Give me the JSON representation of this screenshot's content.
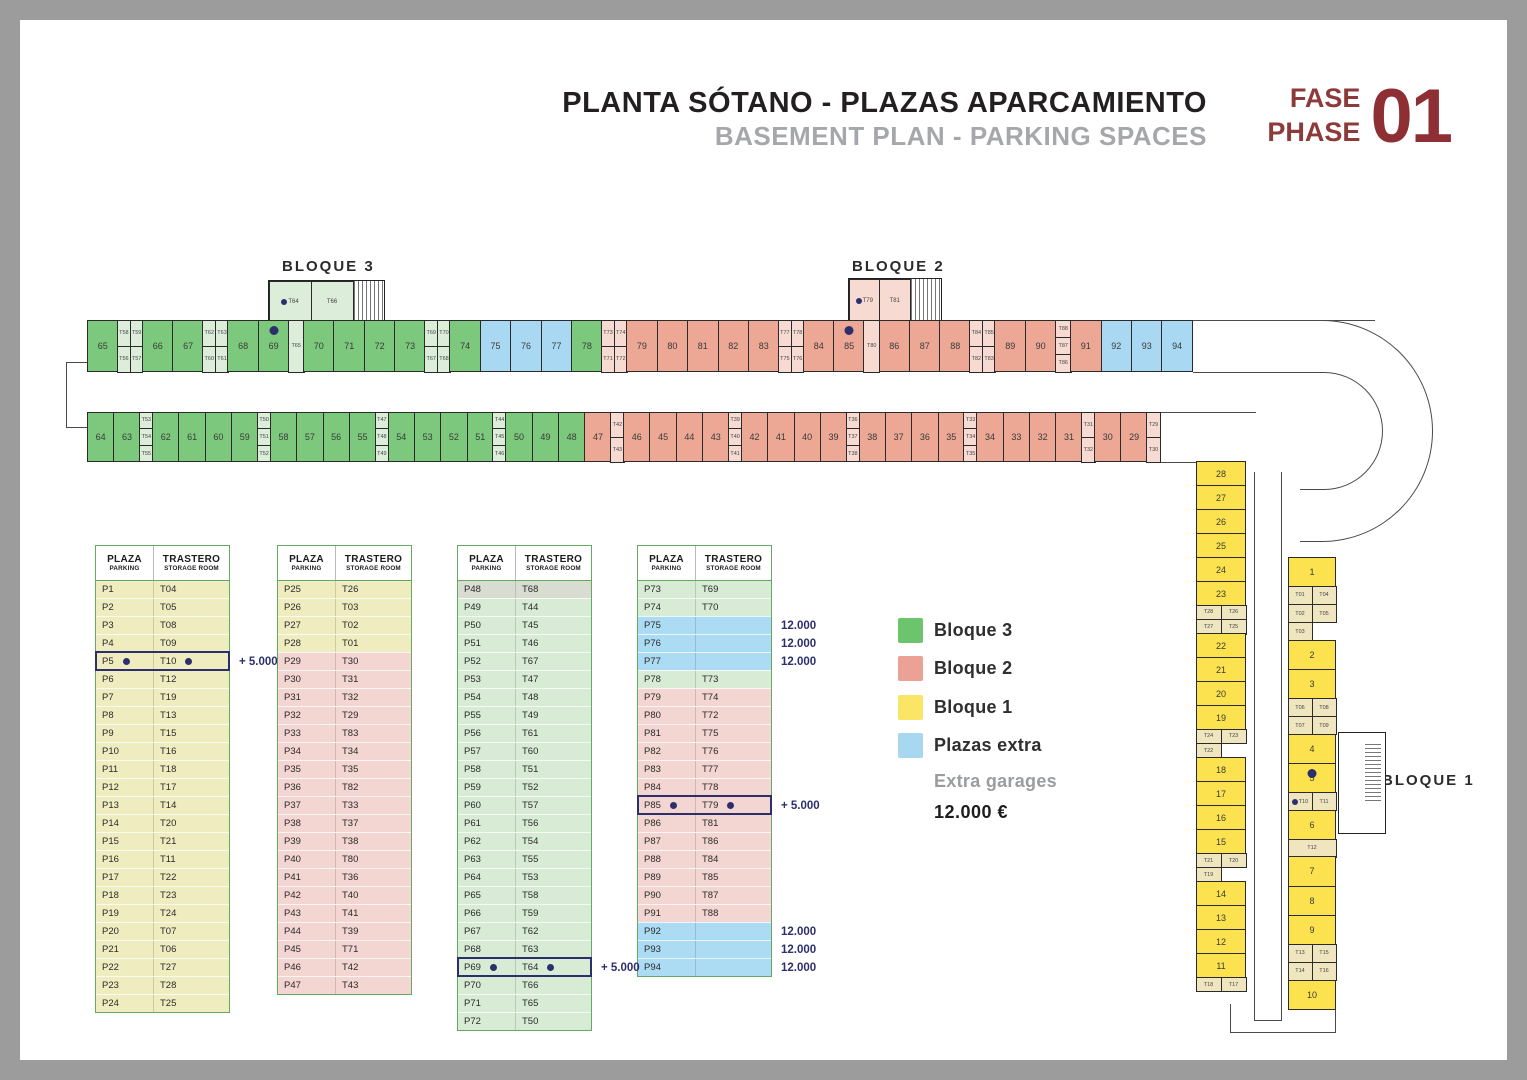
{
  "title": {
    "main": "PLANTA SÓTANO - PLAZAS APARCAMIENTO",
    "sub": "BASEMENT PLAN - PARKING SPACES",
    "fase": "FASE",
    "phase": "PHASE",
    "number": "01"
  },
  "plan": {
    "labels": {
      "bloque3": "BLOQUE 3",
      "bloque2": "BLOQUE 2",
      "bloque1": "BLOQUE 1"
    },
    "top_row": [
      {
        "s": "65",
        "c": "g"
      },
      {
        "st": [
          "T58",
          "T59",
          "T56",
          "T57"
        ],
        "c": "g",
        "w": 2
      },
      {
        "s": "66",
        "c": "g"
      },
      {
        "s": "67",
        "c": "g"
      },
      {
        "st": [
          "T62",
          "T63",
          "T60",
          "T61"
        ],
        "c": "g",
        "w": 2
      },
      {
        "s": "68",
        "c": "g"
      },
      {
        "s": "69",
        "c": "g",
        "dot": true
      },
      {
        "st": [
          "T65"
        ],
        "c": "g",
        "w": 1
      },
      {
        "s": "70",
        "c": "g"
      },
      {
        "s": "71",
        "c": "g"
      },
      {
        "s": "72",
        "c": "g"
      },
      {
        "s": "73",
        "c": "g"
      },
      {
        "st": [
          "T69",
          "T70",
          "T67",
          "T68"
        ],
        "c": "g",
        "w": 2
      },
      {
        "s": "74",
        "c": "g"
      },
      {
        "s": "75",
        "c": "b"
      },
      {
        "s": "76",
        "c": "b"
      },
      {
        "s": "77",
        "c": "b"
      },
      {
        "s": "78",
        "c": "g"
      },
      {
        "st": [
          "T73",
          "T74",
          "T71",
          "T72"
        ],
        "c": "s",
        "w": 2
      },
      {
        "s": "79",
        "c": "s"
      },
      {
        "s": "80",
        "c": "s"
      },
      {
        "s": "81",
        "c": "s"
      },
      {
        "s": "82",
        "c": "s"
      },
      {
        "s": "83",
        "c": "s"
      },
      {
        "st": [
          "T77",
          "T78",
          "T75",
          "T76"
        ],
        "c": "s",
        "w": 2
      },
      {
        "s": "84",
        "c": "s"
      },
      {
        "s": "85",
        "c": "s",
        "dot": true
      },
      {
        "st": [
          "T80"
        ],
        "c": "s",
        "w": 1
      },
      {
        "s": "86",
        "c": "s"
      },
      {
        "s": "87",
        "c": "s"
      },
      {
        "s": "88",
        "c": "s"
      },
      {
        "st": [
          "T84",
          "T85",
          "T82",
          "T83"
        ],
        "c": "s",
        "w": 2
      },
      {
        "s": "89",
        "c": "s"
      },
      {
        "s": "90",
        "c": "s"
      },
      {
        "st": [
          "T88",
          "T87",
          "T86"
        ],
        "c": "s",
        "w": 1
      },
      {
        "s": "91",
        "c": "s"
      },
      {
        "s": "92",
        "c": "b"
      },
      {
        "s": "93",
        "c": "b"
      },
      {
        "s": "94",
        "c": "b"
      }
    ],
    "bottom_row": [
      {
        "s": "64",
        "c": "g"
      },
      {
        "s": "63",
        "c": "g"
      },
      {
        "st": [
          "T53",
          "T54",
          "T55"
        ],
        "c": "g",
        "w": 1
      },
      {
        "s": "62",
        "c": "g"
      },
      {
        "s": "61",
        "c": "g"
      },
      {
        "s": "60",
        "c": "g"
      },
      {
        "s": "59",
        "c": "g"
      },
      {
        "st": [
          "T50",
          "T51",
          "T52"
        ],
        "c": "g",
        "w": 1
      },
      {
        "s": "58",
        "c": "g"
      },
      {
        "s": "57",
        "c": "g"
      },
      {
        "s": "56",
        "c": "g"
      },
      {
        "s": "55",
        "c": "g"
      },
      {
        "st": [
          "T47",
          "T48",
          "T49"
        ],
        "c": "g",
        "w": 1
      },
      {
        "s": "54",
        "c": "g"
      },
      {
        "s": "53",
        "c": "g"
      },
      {
        "s": "52",
        "c": "g"
      },
      {
        "s": "51",
        "c": "g"
      },
      {
        "st": [
          "T44",
          "T45",
          "T46"
        ],
        "c": "g",
        "w": 1
      },
      {
        "s": "50",
        "c": "g"
      },
      {
        "s": "49",
        "c": "g"
      },
      {
        "s": "48",
        "c": "g"
      },
      {
        "s": "47",
        "c": "s"
      },
      {
        "st": [
          "T42",
          "T43"
        ],
        "c": "s",
        "w": 1
      },
      {
        "s": "46",
        "c": "s"
      },
      {
        "s": "45",
        "c": "s"
      },
      {
        "s": "44",
        "c": "s"
      },
      {
        "s": "43",
        "c": "s"
      },
      {
        "st": [
          "T39",
          "T40",
          "T41"
        ],
        "c": "s",
        "w": 1
      },
      {
        "s": "42",
        "c": "s"
      },
      {
        "s": "41",
        "c": "s"
      },
      {
        "s": "40",
        "c": "s"
      },
      {
        "s": "39",
        "c": "s"
      },
      {
        "st": [
          "T36",
          "T37",
          "T38"
        ],
        "c": "s",
        "w": 1
      },
      {
        "s": "38",
        "c": "s"
      },
      {
        "s": "37",
        "c": "s"
      },
      {
        "s": "36",
        "c": "s"
      },
      {
        "s": "35",
        "c": "s"
      },
      {
        "st": [
          "T33",
          "T34",
          "T35"
        ],
        "c": "s",
        "w": 1
      },
      {
        "s": "34",
        "c": "s"
      },
      {
        "s": "33",
        "c": "s"
      },
      {
        "s": "32",
        "c": "s"
      },
      {
        "s": "31",
        "c": "s"
      },
      {
        "st": [
          "T31",
          "T32"
        ],
        "c": "s",
        "w": 1
      },
      {
        "s": "30",
        "c": "s"
      },
      {
        "s": "29",
        "c": "s"
      },
      {
        "st": [
          "T29",
          "T30"
        ],
        "c": "s",
        "w": 1
      }
    ],
    "col_a": [
      {
        "s": "28",
        "c": "y"
      },
      {
        "s": "27",
        "c": "y"
      },
      {
        "s": "26",
        "c": "y"
      },
      {
        "s": "25",
        "c": "y"
      },
      {
        "s": "24",
        "c": "y"
      },
      {
        "s": "23",
        "c": "y"
      },
      {
        "st": [
          "T28",
          "T26",
          "T27",
          "T25"
        ],
        "c": "y",
        "w": 2
      },
      {
        "s": "22",
        "c": "y"
      },
      {
        "s": "21",
        "c": "y"
      },
      {
        "s": "20",
        "c": "y"
      },
      {
        "s": "19",
        "c": "y"
      },
      {
        "st": [
          "T24",
          "T23",
          "T22"
        ],
        "c": "y",
        "w": 2
      },
      {
        "s": "18",
        "c": "y"
      },
      {
        "s": "17",
        "c": "y"
      },
      {
        "s": "16",
        "c": "y"
      },
      {
        "s": "15",
        "c": "y"
      },
      {
        "st": [
          "T21",
          "T20",
          "T19"
        ],
        "c": "y",
        "w": 2
      },
      {
        "s": "14",
        "c": "y"
      },
      {
        "s": "13",
        "c": "y"
      },
      {
        "s": "12",
        "c": "y"
      },
      {
        "s": "11",
        "c": "y"
      },
      {
        "st": [
          "T18",
          "T17"
        ],
        "c": "y",
        "w": 2
      }
    ],
    "col_b": [
      {
        "s": "1",
        "c": "y"
      },
      {
        "st": [
          "T01",
          "T04",
          "T02",
          "T05",
          "T03"
        ],
        "c": "y",
        "w": 2
      },
      {
        "s": "2",
        "c": "y"
      },
      {
        "s": "3",
        "c": "y"
      },
      {
        "st": [
          "T06",
          "T08",
          "T07",
          "T09"
        ],
        "c": "y",
        "w": 2
      },
      {
        "s": "4",
        "c": "y"
      },
      {
        "s": "5",
        "c": "y",
        "dot": true
      },
      {
        "st": [
          "T10*",
          "T11"
        ],
        "c": "y",
        "w": 2
      },
      {
        "s": "6",
        "c": "y"
      },
      {
        "st": [
          "T12"
        ],
        "c": "y",
        "w": 1
      },
      {
        "s": "7",
        "c": "y"
      },
      {
        "s": "8",
        "c": "y"
      },
      {
        "s": "9",
        "c": "y"
      },
      {
        "st": [
          "T13",
          "T15",
          "T14",
          "T16"
        ],
        "c": "y",
        "w": 2
      },
      {
        "s": "10",
        "c": "y"
      }
    ],
    "cores": [
      {
        "id": "core-b3",
        "cells": [
          "T64*",
          "T66"
        ],
        "c": "g"
      },
      {
        "id": "core-b2",
        "cells": [
          "T79*",
          "T81"
        ],
        "c": "s"
      }
    ]
  },
  "table_header": {
    "p_top": "PLAZA",
    "p_sub": "PARKING",
    "t_top": "TRASTERO",
    "t_sub": "STORAGE ROOM"
  },
  "tables": [
    {
      "rows": [
        {
          "p": "P1",
          "t": "T04",
          "c": "y"
        },
        {
          "p": "P2",
          "t": "T05",
          "c": "y"
        },
        {
          "p": "P3",
          "t": "T08",
          "c": "y"
        },
        {
          "p": "P4",
          "t": "T09",
          "c": "y"
        },
        {
          "p": "P5",
          "t": "T10",
          "c": "y",
          "hl": true,
          "note": "+ 5.000"
        },
        {
          "p": "P6",
          "t": "T12",
          "c": "y"
        },
        {
          "p": "P7",
          "t": "T19",
          "c": "y"
        },
        {
          "p": "P8",
          "t": "T13",
          "c": "y"
        },
        {
          "p": "P9",
          "t": "T15",
          "c": "y"
        },
        {
          "p": "P10",
          "t": "T16",
          "c": "y"
        },
        {
          "p": "P11",
          "t": "T18",
          "c": "y"
        },
        {
          "p": "P12",
          "t": "T17",
          "c": "y"
        },
        {
          "p": "P13",
          "t": "T14",
          "c": "y"
        },
        {
          "p": "P14",
          "t": "T20",
          "c": "y"
        },
        {
          "p": "P15",
          "t": "T21",
          "c": "y"
        },
        {
          "p": "P16",
          "t": "T11",
          "c": "y"
        },
        {
          "p": "P17",
          "t": "T22",
          "c": "y"
        },
        {
          "p": "P18",
          "t": "T23",
          "c": "y"
        },
        {
          "p": "P19",
          "t": "T24",
          "c": "y"
        },
        {
          "p": "P20",
          "t": "T07",
          "c": "y"
        },
        {
          "p": "P21",
          "t": "T06",
          "c": "y"
        },
        {
          "p": "P22",
          "t": "T27",
          "c": "y"
        },
        {
          "p": "P23",
          "t": "T28",
          "c": "y"
        },
        {
          "p": "P24",
          "t": "T25",
          "c": "y"
        }
      ]
    },
    {
      "rows": [
        {
          "p": "P25",
          "t": "T26",
          "c": "y"
        },
        {
          "p": "P26",
          "t": "T03",
          "c": "y"
        },
        {
          "p": "P27",
          "t": "T02",
          "c": "y"
        },
        {
          "p": "P28",
          "t": "T01",
          "c": "y"
        },
        {
          "p": "P29",
          "t": "T30",
          "c": "p"
        },
        {
          "p": "P30",
          "t": "T31",
          "c": "p"
        },
        {
          "p": "P31",
          "t": "T32",
          "c": "p"
        },
        {
          "p": "P32",
          "t": "T29",
          "c": "p"
        },
        {
          "p": "P33",
          "t": "T83",
          "c": "p"
        },
        {
          "p": "P34",
          "t": "T34",
          "c": "p"
        },
        {
          "p": "P35",
          "t": "T35",
          "c": "p"
        },
        {
          "p": "P36",
          "t": "T82",
          "c": "p"
        },
        {
          "p": "P37",
          "t": "T33",
          "c": "p"
        },
        {
          "p": "P38",
          "t": "T37",
          "c": "p"
        },
        {
          "p": "P39",
          "t": "T38",
          "c": "p"
        },
        {
          "p": "P40",
          "t": "T80",
          "c": "p"
        },
        {
          "p": "P41",
          "t": "T36",
          "c": "p"
        },
        {
          "p": "P42",
          "t": "T40",
          "c": "p"
        },
        {
          "p": "P43",
          "t": "T41",
          "c": "p"
        },
        {
          "p": "P44",
          "t": "T39",
          "c": "p"
        },
        {
          "p": "P45",
          "t": "T71",
          "c": "p"
        },
        {
          "p": "P46",
          "t": "T42",
          "c": "p"
        },
        {
          "p": "P47",
          "t": "T43",
          "c": "p"
        }
      ]
    },
    {
      "rows": [
        {
          "p": "P48",
          "t": "T68",
          "c": "gray"
        },
        {
          "p": "P49",
          "t": "T44",
          "c": "g"
        },
        {
          "p": "P50",
          "t": "T45",
          "c": "g"
        },
        {
          "p": "P51",
          "t": "T46",
          "c": "g"
        },
        {
          "p": "P52",
          "t": "T67",
          "c": "g"
        },
        {
          "p": "P53",
          "t": "T47",
          "c": "g"
        },
        {
          "p": "P54",
          "t": "T48",
          "c": "g"
        },
        {
          "p": "P55",
          "t": "T49",
          "c": "g"
        },
        {
          "p": "P56",
          "t": "T61",
          "c": "g"
        },
        {
          "p": "P57",
          "t": "T60",
          "c": "g"
        },
        {
          "p": "P58",
          "t": "T51",
          "c": "g"
        },
        {
          "p": "P59",
          "t": "T52",
          "c": "g"
        },
        {
          "p": "P60",
          "t": "T57",
          "c": "g"
        },
        {
          "p": "P61",
          "t": "T56",
          "c": "g"
        },
        {
          "p": "P62",
          "t": "T54",
          "c": "g"
        },
        {
          "p": "P63",
          "t": "T55",
          "c": "g"
        },
        {
          "p": "P64",
          "t": "T53",
          "c": "g"
        },
        {
          "p": "P65",
          "t": "T58",
          "c": "g"
        },
        {
          "p": "P66",
          "t": "T59",
          "c": "g"
        },
        {
          "p": "P67",
          "t": "T62",
          "c": "g"
        },
        {
          "p": "P68",
          "t": "T63",
          "c": "g"
        },
        {
          "p": "P69",
          "t": "T64",
          "c": "g",
          "hl": true,
          "note": "+ 5.000"
        },
        {
          "p": "P70",
          "t": "T66",
          "c": "g"
        },
        {
          "p": "P71",
          "t": "T65",
          "c": "g"
        },
        {
          "p": "P72",
          "t": "T50",
          "c": "g"
        }
      ]
    },
    {
      "rows": [
        {
          "p": "P73",
          "t": "T69",
          "c": "g"
        },
        {
          "p": "P74",
          "t": "T70",
          "c": "g"
        },
        {
          "p": "P75",
          "t": "",
          "c": "bl",
          "note": "12.000"
        },
        {
          "p": "P76",
          "t": "",
          "c": "bl",
          "note": "12.000"
        },
        {
          "p": "P77",
          "t": "",
          "c": "bl",
          "note": "12.000"
        },
        {
          "p": "P78",
          "t": "T73",
          "c": "g"
        },
        {
          "p": "P79",
          "t": "T74",
          "c": "p"
        },
        {
          "p": "P80",
          "t": "T72",
          "c": "p"
        },
        {
          "p": "P81",
          "t": "T75",
          "c": "p"
        },
        {
          "p": "P82",
          "t": "T76",
          "c": "p"
        },
        {
          "p": "P83",
          "t": "T77",
          "c": "p"
        },
        {
          "p": "P84",
          "t": "T78",
          "c": "p"
        },
        {
          "p": "P85",
          "t": "T79",
          "c": "p",
          "hl": true,
          "note": "+ 5.000"
        },
        {
          "p": "P86",
          "t": "T81",
          "c": "p"
        },
        {
          "p": "P87",
          "t": "T86",
          "c": "p"
        },
        {
          "p": "P88",
          "t": "T84",
          "c": "p"
        },
        {
          "p": "P89",
          "t": "T85",
          "c": "p"
        },
        {
          "p": "P90",
          "t": "T87",
          "c": "p"
        },
        {
          "p": "P91",
          "t": "T88",
          "c": "p"
        },
        {
          "p": "P92",
          "t": "",
          "c": "bl",
          "note": "12.000"
        },
        {
          "p": "P93",
          "t": "",
          "c": "bl",
          "note": "12.000"
        },
        {
          "p": "P94",
          "t": "",
          "c": "bl",
          "note": "12.000"
        }
      ]
    }
  ],
  "legend": {
    "items": [
      {
        "label": "Bloque 3",
        "color": "#6cc56c"
      },
      {
        "label": "Bloque 2",
        "color": "#eba193"
      },
      {
        "label": "Bloque 1",
        "color": "#fbe566"
      },
      {
        "label": "Plazas extra",
        "color": "#a8d8f0"
      }
    ],
    "sub_label": "Extra garages",
    "price": "12.000 €"
  },
  "colors": {
    "bloque3_green": "#7cc87c",
    "bloque2_salmon": "#eca795",
    "bloque1_yellow": "#fbe24e",
    "extra_blue": "#a9d9f2",
    "highlight_navy": "#2d2f6d",
    "phase_red": "#8e2f34",
    "frame_gray": "#9c9c9c"
  }
}
